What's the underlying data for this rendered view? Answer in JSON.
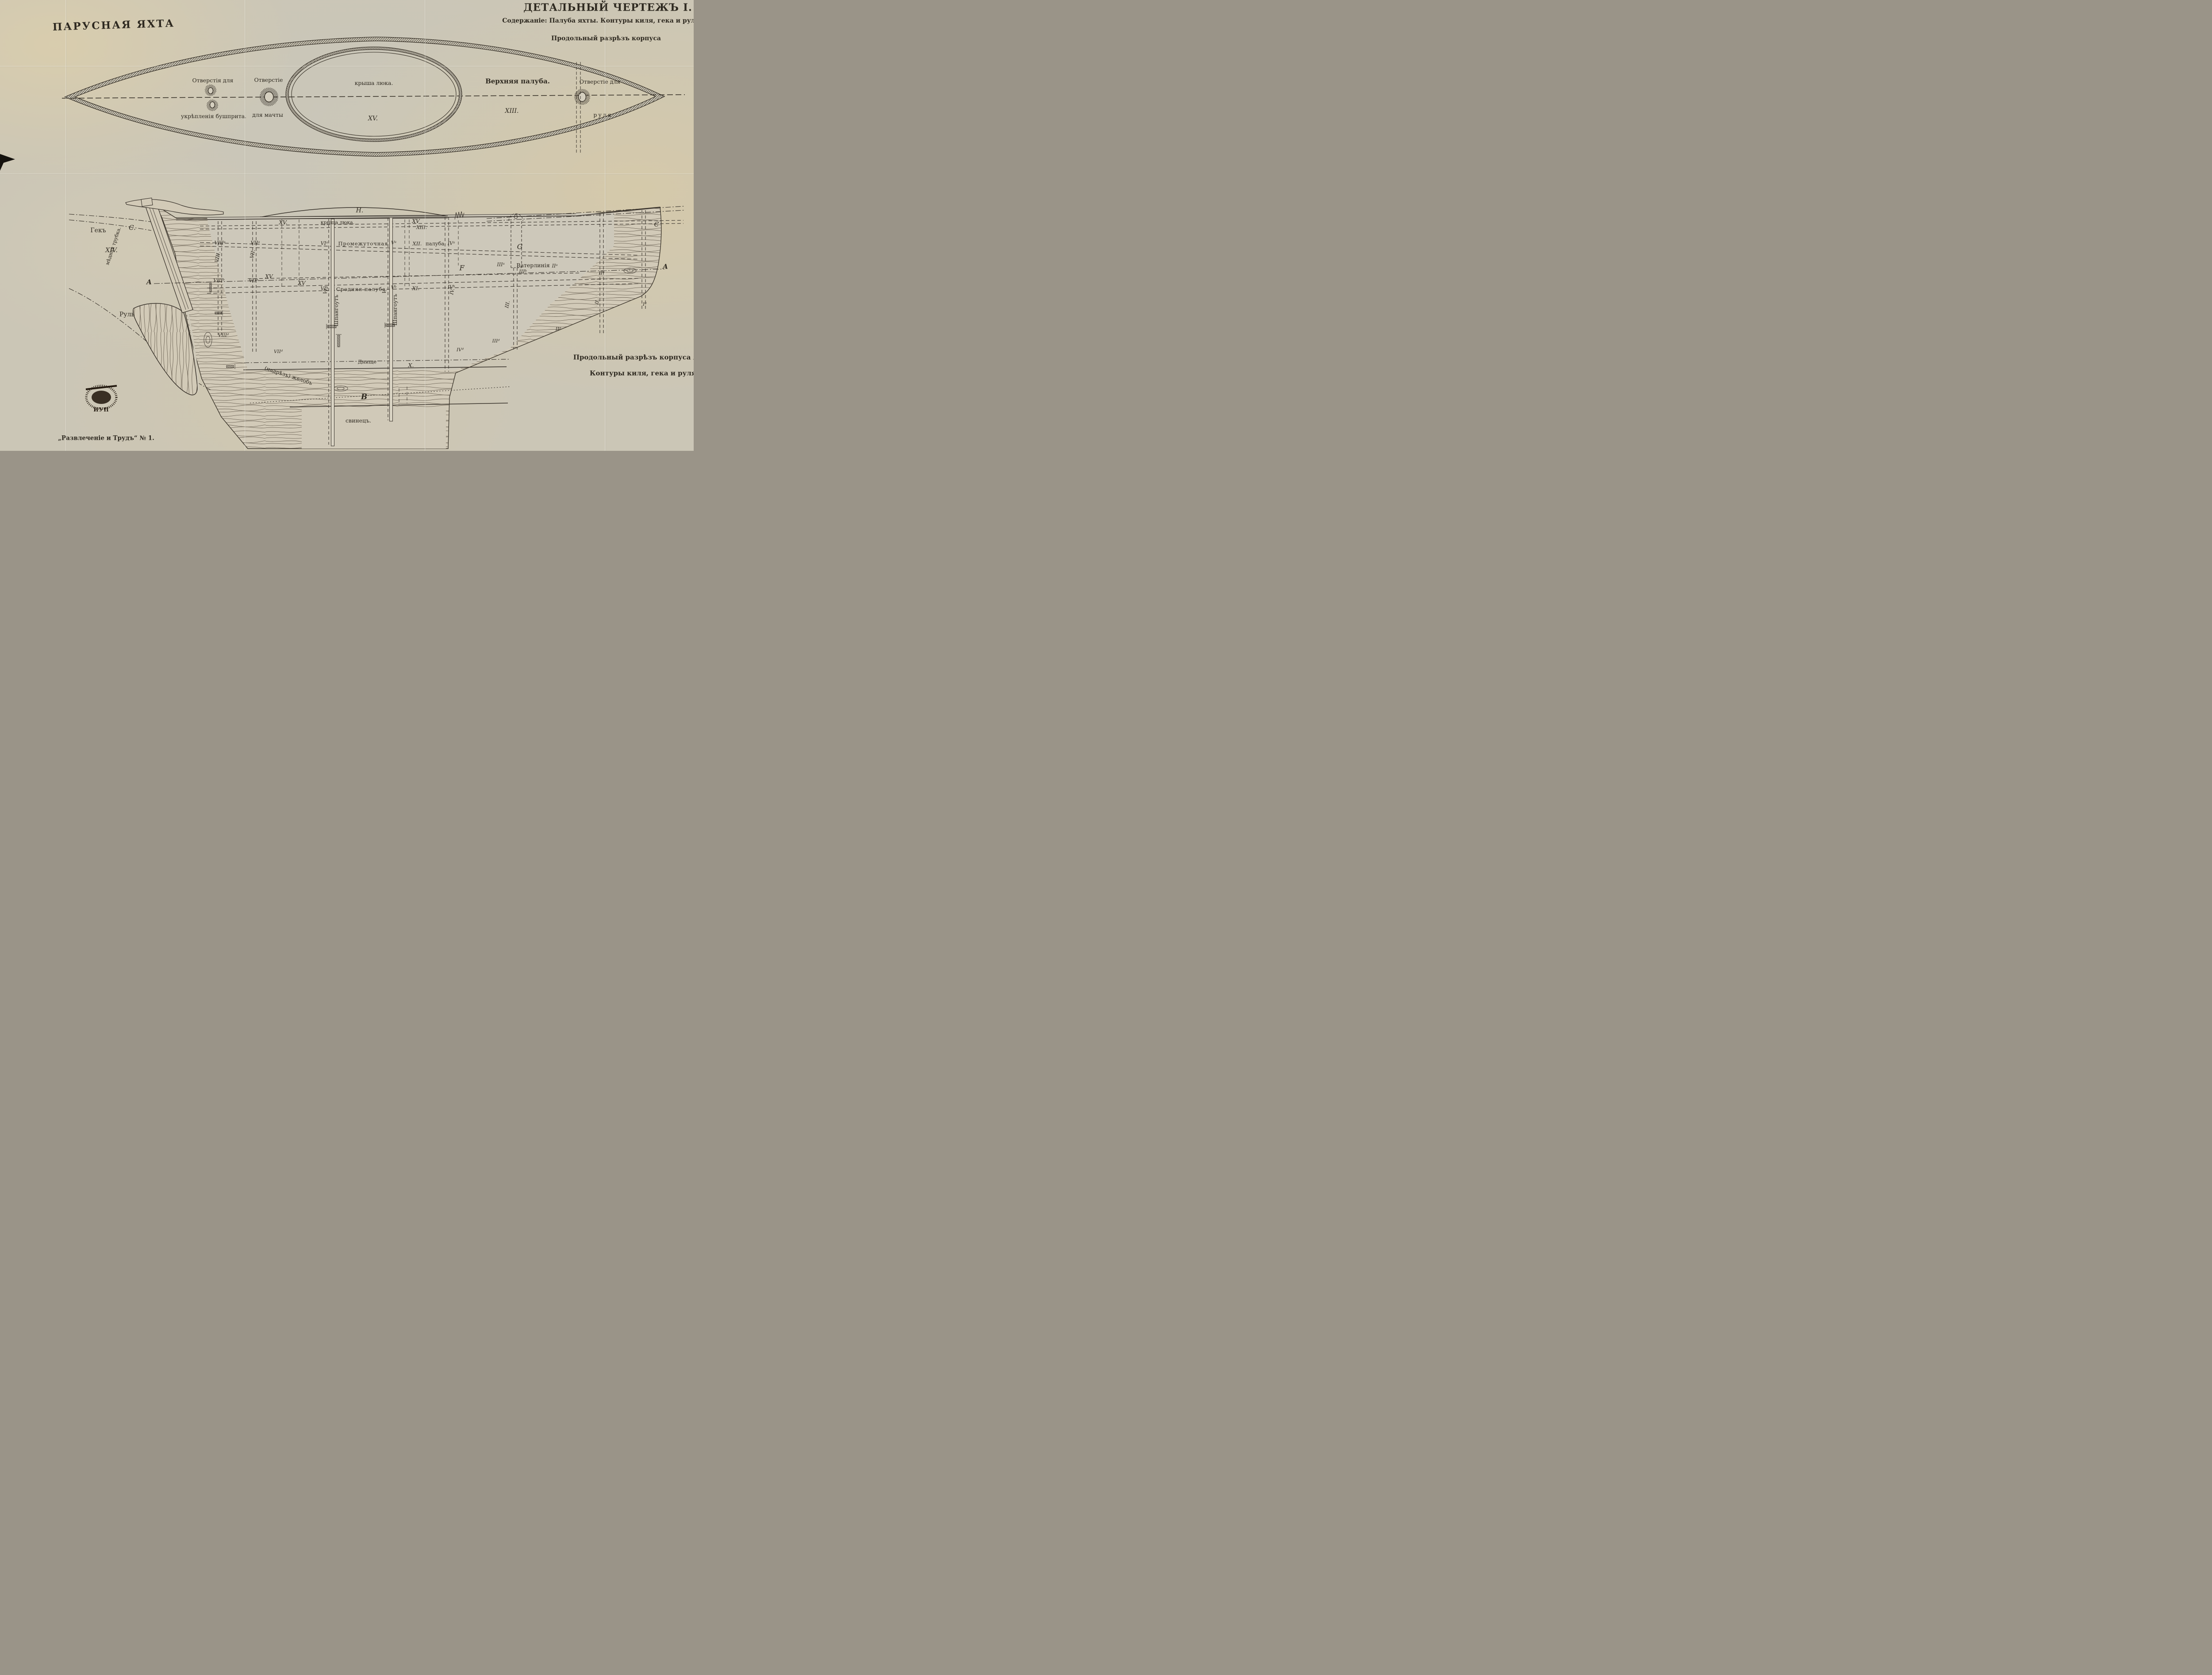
{
  "titles": {
    "main": "ПАРУСНАЯ ЯХТА",
    "sheet": "ДЕТАЛЬНЫЙ ЧЕРТЕЖЪ I.",
    "contents": "Содержаніе: Палуба яхты. Контуры киля, гека и руля.",
    "section_note": "Продольный разрѣзъ корпуса",
    "bottom_right_1": "Продольный разрѣзъ корпуса яхты.",
    "bottom_right_2": "Контуры киля, гека и руля.",
    "footer": "„Развлеченіе и Трудъ“ № 1."
  },
  "deck_plan": {
    "bowsprit_label_1": "Отверстія для",
    "bowsprit_label_2": "укрѣпленія бушприта.",
    "mast_label_1": "Отверстіе",
    "mast_label_2": "для мачты",
    "hatch_label": "крыша люка.",
    "hatch_numeral": "XV.",
    "deck_label": "Верхняя палуба.",
    "deck_numeral": "XIII.",
    "rudder_label_1": "Отверстіе для",
    "rudder_label_2": "руля"
  },
  "section": {
    "letters": {
      "H": "H.",
      "C_stern": "C.",
      "C_bow": "C",
      "G": "G",
      "F": "F",
      "A_left": "A",
      "A_right": "A",
      "B": "B"
    },
    "stern": {
      "gek": "Гекъ",
      "gek_numeral": "XIV.",
      "copper_tube": "мѣдная трубка.",
      "rudder": "Руль",
      "groove": "(надрѣзъ) желобъ"
    },
    "decks": {
      "hatch_label": "крыша люка.",
      "hatch_xv_left": "XV.",
      "xv_plain": "XV",
      "xiii": "XIII.",
      "intermediate_1": "Промежуточная",
      "intermediate_numeral": "XII.",
      "intermediate_2": "палуба",
      "middle": "Средняя палуба",
      "middle_numeral": "XI.",
      "waterline": "Ватерлинія",
      "bottom": "Днище",
      "bottom_numeral": "X.",
      "lead": "свинецъ.",
      "frame_word": "Шпангоутъ"
    },
    "frames_a": [
      "VIIIᵃ",
      "VIIᵃ",
      "VIᵃ",
      "Vᵃ",
      "IVᵃ",
      "IIIᵃ",
      "IIᵃ"
    ],
    "frames_b": [
      "VIIIᵇ",
      "VIIᵇ",
      "VIᵇ",
      "Vᵇ",
      "IVᵇ",
      "IIIᵇ",
      "IIᵇ"
    ],
    "frames_rot": [
      "VIII.",
      "VII.",
      "VI.",
      "V.",
      "IV.",
      "III.",
      "II."
    ],
    "frames_d": [
      "VIIIᵈ",
      "VIIᵈ",
      "IVᵈ",
      "IIIᵈ",
      "IIᵈ",
      "Iᵈ"
    ]
  },
  "stamp": {
    "text": "ИУП"
  }
}
